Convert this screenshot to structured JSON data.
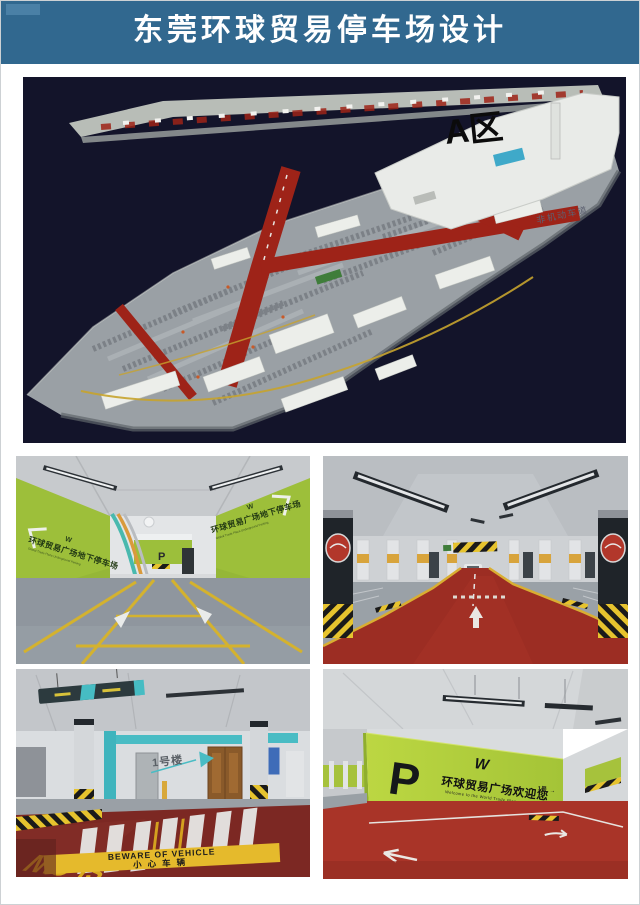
{
  "header": {
    "title": "东莞环球贸易停车场设计",
    "bg_color": "#31688f",
    "text_color": "#ffffff"
  },
  "master_plan": {
    "zone_label": "A区",
    "lane_label": "非机动车道",
    "colors": {
      "background": "#13142a",
      "deck_gray": "#9aa0a5",
      "road_red": "#9e2318",
      "line_yellow": "#c7a32e",
      "building_white": "#eceeea"
    }
  },
  "icons": {
    "w_logo": "W",
    "up_arrow": "↑",
    "right_arrow": "→"
  },
  "panels": {
    "entrance": {
      "wall_text_cn": "环球贸易广场地下停车场",
      "wall_text_en": "Global Trade Plaza Underground Parking",
      "p_sign": "P",
      "wall_green": "#9dbf3a",
      "floor_gray": "#8f969e",
      "line_yellow": "#d4b22e"
    },
    "red_aisle": {
      "floor_red": "#9c2d23",
      "band_yellow": "#d8a43c"
    },
    "crosswalk": {
      "building_sign": "1号楼",
      "floor_slow": "SLOW",
      "warning_en": "BEWARE OF VEHICLE",
      "warning_cn": "小心车辆",
      "floor_red": "#7c2823",
      "accent_teal": "#49bcc4",
      "band_yellow": "#e5ba2c"
    },
    "welcome_wall": {
      "p_sign": "P",
      "welcome_cn": "环球贸易广场欢迎您",
      "welcome_en": "Welcome to the World Trade Plaza",
      "route_label": "1-2号",
      "zone_small_sign": "1号",
      "wall_green": "#b5d23f",
      "floor_red": "#a93428"
    }
  }
}
